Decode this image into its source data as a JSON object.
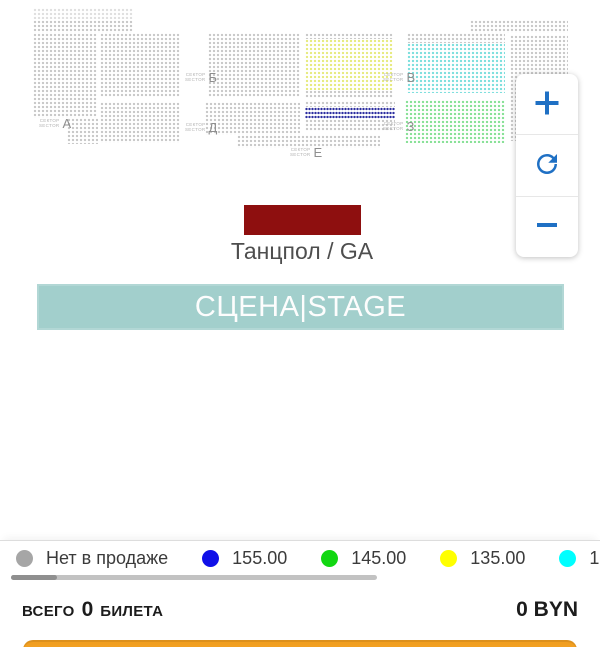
{
  "map": {
    "sector_word_ru": "СЕКТОР",
    "sector_word_en": "SECTOR",
    "sectors": [
      {
        "letter": "А",
        "x": 39,
        "y": 116
      },
      {
        "letter": "Б",
        "x": 185,
        "y": 70
      },
      {
        "letter": "Д",
        "x": 185,
        "y": 120
      },
      {
        "letter": "В",
        "x": 383,
        "y": 70
      },
      {
        "letter": "З",
        "x": 383,
        "y": 119
      },
      {
        "letter": "Е",
        "x": 290,
        "y": 145
      }
    ],
    "blocks": [
      {
        "name": "a-top-light",
        "x": 33,
        "y": 8,
        "w": 100,
        "h": 11,
        "color": "#dfdfdf",
        "interactable": false
      },
      {
        "name": "a-top",
        "x": 33,
        "y": 20,
        "w": 100,
        "h": 13,
        "color": "#c7c7c7",
        "interactable": false
      },
      {
        "name": "sector-a",
        "x": 33,
        "y": 33,
        "w": 64,
        "h": 85,
        "color": "#c7c7c7",
        "interactable": false
      },
      {
        "name": "sector-a-lower",
        "x": 67,
        "y": 118,
        "w": 31,
        "h": 26,
        "color": "#c7c7c7",
        "interactable": false
      },
      {
        "name": "sector-b-upper",
        "x": 100,
        "y": 33,
        "w": 80,
        "h": 64,
        "color": "#c7c7c7",
        "interactable": false
      },
      {
        "name": "sector-b-lower",
        "x": 100,
        "y": 102,
        "w": 80,
        "h": 41,
        "color": "#c7c7c7",
        "interactable": false
      },
      {
        "name": "sector-d-upper",
        "x": 208,
        "y": 33,
        "w": 92,
        "h": 64,
        "color": "#c7c7c7",
        "interactable": false
      },
      {
        "name": "sector-d-lower",
        "x": 205,
        "y": 102,
        "w": 95,
        "h": 33,
        "color": "#c7c7c7",
        "interactable": false
      },
      {
        "name": "sector-e-strip",
        "x": 237,
        "y": 135,
        "w": 143,
        "h": 13,
        "color": "#c7c7c7",
        "interactable": false
      },
      {
        "name": "sector-v-top-gray",
        "x": 305,
        "y": 33,
        "w": 88,
        "h": 6,
        "color": "#c7c7c7",
        "interactable": false
      },
      {
        "name": "sector-v-yellow",
        "x": 305,
        "y": 39,
        "w": 88,
        "h": 51,
        "color": "#e6ea7d",
        "interactable": true
      },
      {
        "name": "sector-v-bottom-gray",
        "x": 305,
        "y": 90,
        "w": 88,
        "h": 8,
        "color": "#c7c7c7",
        "interactable": false
      },
      {
        "name": "sector-z-gray-upper",
        "x": 305,
        "y": 101,
        "w": 90,
        "h": 6,
        "color": "#c7c7c7",
        "interactable": false
      },
      {
        "name": "sector-z-blue",
        "x": 305,
        "y": 107,
        "w": 90,
        "h": 12,
        "color": "#2c2da0",
        "dense": true,
        "interactable": true
      },
      {
        "name": "sector-z-gray-lower",
        "x": 305,
        "y": 119,
        "w": 90,
        "h": 12,
        "color": "#c7c7c7",
        "interactable": false
      },
      {
        "name": "sector-zh-top-gray",
        "x": 407,
        "y": 33,
        "w": 98,
        "h": 10,
        "color": "#c7c7c7",
        "interactable": false
      },
      {
        "name": "sector-zh-cyan",
        "x": 407,
        "y": 43,
        "w": 98,
        "h": 50,
        "color": "#7adedd",
        "interactable": true
      },
      {
        "name": "sector-z-green",
        "x": 405,
        "y": 100,
        "w": 100,
        "h": 43,
        "color": "#85e094",
        "interactable": true
      },
      {
        "name": "right-top-strip",
        "x": 470,
        "y": 20,
        "w": 98,
        "h": 13,
        "color": "#c7c7c7",
        "interactable": false
      },
      {
        "name": "right-block",
        "x": 510,
        "y": 35,
        "w": 58,
        "h": 106,
        "color": "#c7c7c7",
        "interactable": false
      }
    ],
    "ga_zone": {
      "label": "Танцпол / GA",
      "color": "#8e0f0f"
    },
    "stage": {
      "label": "СЦЕНА|STAGE",
      "color": "#a2cfcc"
    }
  },
  "controls": {
    "zoom_in_icon": "plus",
    "rotate_icon": "rotate-clockwise",
    "zoom_out_icon": "minus",
    "icon_color": "#1f70c4"
  },
  "legend": {
    "items": [
      {
        "label": "Нет в продаже",
        "color": "#a6a6a6"
      },
      {
        "label": "155.00",
        "color": "#1010e8"
      },
      {
        "label": "145.00",
        "color": "#12d712"
      },
      {
        "label": "135.00",
        "color": "#ffff00"
      },
      {
        "label": "1",
        "color": "#00ffff"
      }
    ]
  },
  "summary": {
    "total_label": "ВСЕГО",
    "total_count": "0",
    "total_unit": "БИЛЕТА",
    "total_price": "0 BYN"
  },
  "cta": {
    "color_top": "#ef9c1e",
    "color_bottom": "#f9ab2e"
  }
}
